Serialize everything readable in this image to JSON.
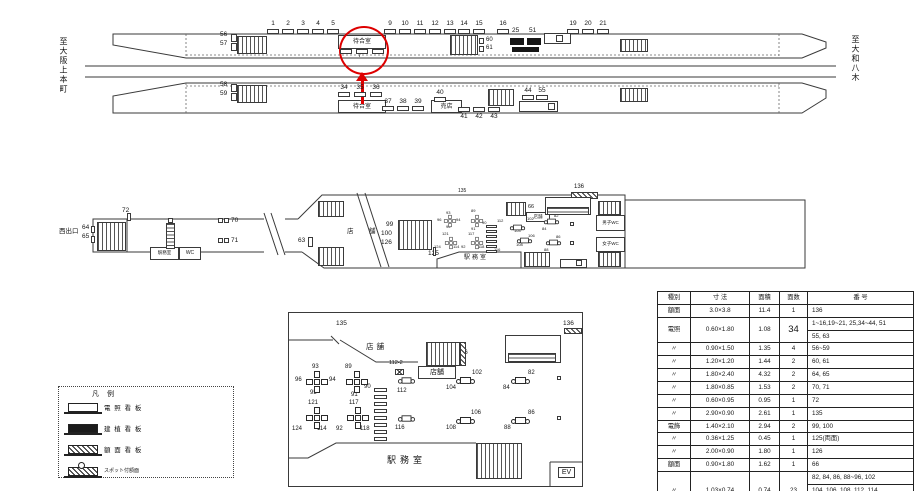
{
  "page": {
    "accent_red": "#dd0000"
  },
  "top_diagram": {
    "left_dest": "至大阪上本町",
    "right_dest": "至大和八木",
    "waiting_room": "待合室",
    "kiosk": "売店",
    "annotation": {
      "circled_board_number": "7",
      "color": "#dd0000"
    },
    "upper_ticks": [
      {
        "n": "1",
        "x": 273
      },
      {
        "n": "2",
        "x": 288
      },
      {
        "n": "3",
        "x": 303
      },
      {
        "n": "4",
        "x": 318
      },
      {
        "n": "5",
        "x": 333
      },
      {
        "n": "9",
        "x": 390
      },
      {
        "n": "10",
        "x": 405
      },
      {
        "n": "11",
        "x": 420
      },
      {
        "n": "12",
        "x": 435
      },
      {
        "n": "13",
        "x": 450
      },
      {
        "n": "14",
        "x": 464
      },
      {
        "n": "15",
        "x": 479
      },
      {
        "n": "16",
        "x": 503
      },
      {
        "n": "19",
        "x": 573
      },
      {
        "n": "20",
        "x": 588
      },
      {
        "n": "21",
        "x": 603
      }
    ],
    "lower_ticks": [
      {
        "n": "34",
        "x": 344,
        "ny": 85,
        "by": 92
      },
      {
        "n": "35",
        "x": 360,
        "ny": 85,
        "by": 92
      },
      {
        "n": "36",
        "x": 376,
        "ny": 85,
        "by": 92
      },
      {
        "n": "37",
        "x": 388,
        "ny": 99,
        "by": 106
      },
      {
        "n": "38",
        "x": 403,
        "ny": 99,
        "by": 106
      },
      {
        "n": "39",
        "x": 418,
        "ny": 99,
        "by": 106
      },
      {
        "n": "40",
        "x": 440,
        "ny": 90,
        "by": 97
      },
      {
        "n": "41",
        "x": 464,
        "ny": 114,
        "by": 107
      },
      {
        "n": "42",
        "x": 479,
        "ny": 114,
        "by": 107
      },
      {
        "n": "43",
        "x": 494,
        "ny": 114,
        "by": 107
      },
      {
        "n": "44",
        "x": 528,
        "ny": 88,
        "by": 95
      },
      {
        "n": "55",
        "x": 542,
        "ny": 88,
        "by": 95
      }
    ],
    "labels": [
      {
        "t": "56",
        "x": 220,
        "y": 32,
        "s": 6.5
      },
      {
        "t": "57",
        "x": 220,
        "y": 41,
        "s": 6.5
      },
      {
        "t": "58",
        "x": 220,
        "y": 82,
        "s": 6.5
      },
      {
        "t": "59",
        "x": 220,
        "y": 91,
        "s": 6.5
      },
      {
        "t": "60",
        "x": 486,
        "y": 37,
        "s": 6
      },
      {
        "t": "61",
        "x": 486,
        "y": 45,
        "s": 6
      },
      {
        "t": "25",
        "x": 512,
        "y": 28,
        "s": 6.5
      },
      {
        "t": "51",
        "x": 529,
        "y": 28,
        "s": 6.5
      },
      {
        "t": "7",
        "x": 358,
        "y": 53,
        "s": 6
      }
    ]
  },
  "concourse": {
    "west_exit": "西出口",
    "office": "駅務室",
    "wc": "WC",
    "hall_office": "駅務室",
    "shop_box": "店舗",
    "mens_wc": "男子WC",
    "womens_wc": "女子WC",
    "ev": "EV",
    "labels": [
      {
        "t": "西出口",
        "x": 59,
        "y": 229,
        "s": 6.5
      },
      {
        "t": "64",
        "x": 82,
        "y": 225,
        "s": 6.5
      },
      {
        "t": "65",
        "x": 82,
        "y": 234,
        "s": 6.5
      },
      {
        "t": "72",
        "x": 122,
        "y": 208,
        "s": 6.5
      },
      {
        "t": "70",
        "x": 231,
        "y": 218,
        "s": 6.5
      },
      {
        "t": "71",
        "x": 231,
        "y": 238,
        "s": 6.5
      },
      {
        "t": "63",
        "x": 298,
        "y": 238,
        "s": 6.5
      },
      {
        "t": "店",
        "x": 347,
        "y": 229,
        "s": 6.5
      },
      {
        "t": "舗",
        "x": 369,
        "y": 229,
        "s": 6.5
      },
      {
        "t": "99",
        "x": 386,
        "y": 222,
        "s": 6.5
      },
      {
        "t": "100",
        "x": 381,
        "y": 231,
        "s": 6.5
      },
      {
        "t": "126",
        "x": 381,
        "y": 240,
        "s": 6.5
      },
      {
        "t": "125",
        "x": 428,
        "y": 251,
        "s": 6.5
      },
      {
        "t": "135",
        "x": 458,
        "y": 189,
        "s": 5
      },
      {
        "t": "66",
        "x": 528,
        "y": 205,
        "s": 5.5
      },
      {
        "t": "136",
        "x": 574,
        "y": 184,
        "s": 6
      },
      {
        "t": "駅務室",
        "x": 464,
        "y": 255,
        "s": 6,
        "ls": 2
      },
      {
        "t": "93",
        "x": 446,
        "y": 211,
        "s": 4
      },
      {
        "t": "96",
        "x": 437,
        "y": 218,
        "s": 4
      },
      {
        "t": "94",
        "x": 456,
        "y": 218,
        "s": 4
      },
      {
        "t": "95",
        "x": 446,
        "y": 225,
        "s": 4
      },
      {
        "t": "121",
        "x": 442,
        "y": 232,
        "s": 4
      },
      {
        "t": "124",
        "x": 434,
        "y": 245,
        "s": 4
      },
      {
        "t": "114",
        "x": 453,
        "y": 245,
        "s": 4
      },
      {
        "t": "89",
        "x": 471,
        "y": 209,
        "s": 4
      },
      {
        "t": "90",
        "x": 482,
        "y": 221,
        "s": 4
      },
      {
        "t": "91",
        "x": 471,
        "y": 227,
        "s": 4
      },
      {
        "t": "117",
        "x": 468,
        "y": 232,
        "s": 4
      },
      {
        "t": "92",
        "x": 461,
        "y": 245,
        "s": 4
      },
      {
        "t": "118",
        "x": 478,
        "y": 245,
        "s": 4
      },
      {
        "t": "112",
        "x": 497,
        "y": 219,
        "s": 4
      },
      {
        "t": "116",
        "x": 494,
        "y": 248,
        "s": 4
      },
      {
        "t": "104",
        "x": 514,
        "y": 229,
        "s": 4
      },
      {
        "t": "102",
        "x": 527,
        "y": 217,
        "s": 4
      },
      {
        "t": "84",
        "x": 542,
        "y": 227,
        "s": 4
      },
      {
        "t": "82",
        "x": 554,
        "y": 214,
        "s": 4
      },
      {
        "t": "106",
        "x": 528,
        "y": 234,
        "s": 4
      },
      {
        "t": "108",
        "x": 516,
        "y": 243,
        "s": 4
      },
      {
        "t": "86",
        "x": 556,
        "y": 235,
        "s": 4
      },
      {
        "t": "88",
        "x": 544,
        "y": 248,
        "s": 4
      }
    ]
  },
  "legend": {
    "title": "凡 例",
    "items": [
      {
        "label": "電 照 看 板",
        "symbol": "lighted"
      },
      {
        "label": "建 植 看 板",
        "symbol": "standing"
      },
      {
        "label": "額 面 看 板",
        "symbol": "face"
      },
      {
        "label": "スポット付額面",
        "symbol": "spot-face"
      }
    ]
  },
  "detail": {
    "shop1": "店舗",
    "shop2": "店舗",
    "office": "駅務室",
    "ev": "EV",
    "labels": [
      {
        "t": "135",
        "x": 336,
        "y": 321,
        "s": 6.5
      },
      {
        "t": "136",
        "x": 563,
        "y": 321,
        "s": 6.5
      },
      {
        "t": "66",
        "x": 461,
        "y": 350,
        "s": 6
      },
      {
        "t": "112-2",
        "x": 389,
        "y": 361,
        "s": 5.5
      },
      {
        "t": "112",
        "x": 397,
        "y": 388,
        "s": 6
      },
      {
        "t": "116",
        "x": 395,
        "y": 425,
        "s": 6
      },
      {
        "t": "93",
        "x": 312,
        "y": 364,
        "s": 6
      },
      {
        "t": "96",
        "x": 295,
        "y": 377,
        "s": 6
      },
      {
        "t": "94",
        "x": 329,
        "y": 377,
        "s": 6
      },
      {
        "t": "95",
        "x": 310,
        "y": 390,
        "s": 6
      },
      {
        "t": "89",
        "x": 345,
        "y": 364,
        "s": 6
      },
      {
        "t": "90",
        "x": 364,
        "y": 384,
        "s": 6
      },
      {
        "t": "91",
        "x": 351,
        "y": 392,
        "s": 6
      },
      {
        "t": "121",
        "x": 308,
        "y": 400,
        "s": 6
      },
      {
        "t": "124",
        "x": 292,
        "y": 426,
        "s": 6
      },
      {
        "t": "114",
        "x": 317,
        "y": 426,
        "s": 6
      },
      {
        "t": "117",
        "x": 349,
        "y": 400,
        "s": 6
      },
      {
        "t": "92",
        "x": 336,
        "y": 426,
        "s": 6
      },
      {
        "t": "118",
        "x": 360,
        "y": 426,
        "s": 6
      },
      {
        "t": "102",
        "x": 472,
        "y": 370,
        "s": 6
      },
      {
        "t": "104",
        "x": 446,
        "y": 385,
        "s": 6
      },
      {
        "t": "82",
        "x": 528,
        "y": 370,
        "s": 6
      },
      {
        "t": "84",
        "x": 503,
        "y": 385,
        "s": 6
      },
      {
        "t": "106",
        "x": 471,
        "y": 410,
        "s": 6
      },
      {
        "t": "108",
        "x": 446,
        "y": 425,
        "s": 6
      },
      {
        "t": "86",
        "x": 528,
        "y": 410,
        "s": 6
      },
      {
        "t": "88",
        "x": 504,
        "y": 425,
        "s": 6
      },
      {
        "t": "店舗",
        "x": 366,
        "y": 343,
        "s": 7.5,
        "ls": 3
      },
      {
        "t": "駅務室",
        "x": 387,
        "y": 456,
        "s": 9,
        "ls": 4
      }
    ]
  },
  "table": {
    "headers": [
      "種別",
      "寸 法",
      "面積",
      "面数",
      "番 号"
    ],
    "rows": [
      {
        "type": "額面",
        "size": "3.0×3.8",
        "area": "11.4",
        "count": "1",
        "numbers": [
          "136"
        ]
      },
      {
        "type": "電照",
        "size": "0.60×1.80",
        "area": "1.08",
        "count": "34",
        "count_big": true,
        "numbers": [
          "1~16,19~21, 25,34~44, 51",
          "55, 63"
        ]
      },
      {
        "type": "〃",
        "size": "0.90×1.50",
        "area": "1.35",
        "count": "4",
        "numbers": [
          "56~59"
        ]
      },
      {
        "type": "〃",
        "size": "1.20×1.20",
        "area": "1.44",
        "count": "2",
        "numbers": [
          "60, 61"
        ]
      },
      {
        "type": "〃",
        "size": "1.80×2.40",
        "area": "4.32",
        "count": "2",
        "numbers": [
          "64, 65"
        ]
      },
      {
        "type": "〃",
        "size": "1.80×0.85",
        "area": "1.53",
        "count": "2",
        "numbers": [
          "70, 71"
        ]
      },
      {
        "type": "〃",
        "size": "0.60×0.95",
        "area": "0.95",
        "count": "1",
        "numbers": [
          "72"
        ]
      },
      {
        "type": "〃",
        "size": "2.90×0.90",
        "area": "2.61",
        "count": "1",
        "numbers": [
          "135"
        ]
      },
      {
        "type": "電飾",
        "size": "1.40×2.10",
        "area": "2.94",
        "count": "2",
        "numbers": [
          "99, 100"
        ]
      },
      {
        "type": "〃",
        "size": "0.36×1.25",
        "area": "0.45",
        "count": "1",
        "numbers": [
          "125(両面)"
        ]
      },
      {
        "type": "〃",
        "size": "2.00×0.90",
        "area": "1.80",
        "count": "1",
        "numbers": [
          "126"
        ]
      },
      {
        "type": "額面",
        "size": "0.90×1.80",
        "area": "1.62",
        "count": "1",
        "numbers": [
          "66"
        ]
      },
      {
        "type": "〃",
        "size": "1.03×0.74",
        "area": "0.74",
        "count": "23",
        "numbers": [
          "82, 84, 86, 88~96, 102",
          "104, 106, 108, 112, 114",
          "116~118, 121, 124"
        ]
      }
    ]
  }
}
